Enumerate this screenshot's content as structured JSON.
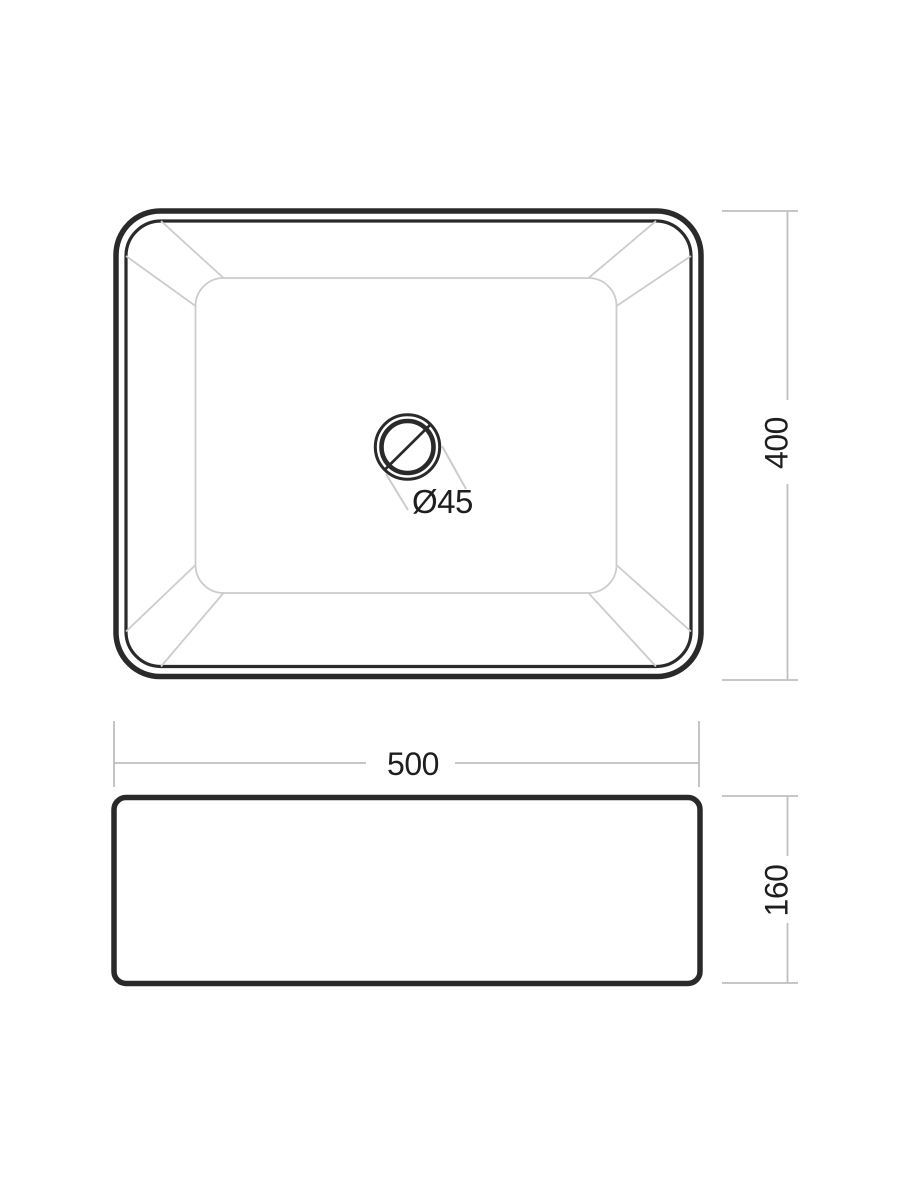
{
  "drawing": {
    "kind": "technical-dimension-drawing",
    "subject": "rectangular-countertop-washbasin",
    "views": [
      "top-view",
      "side-view"
    ]
  },
  "dimensions": {
    "width": {
      "label": "500"
    },
    "depth": {
      "label": "400"
    },
    "height": {
      "label": "160"
    },
    "drain_diameter": {
      "label": "Ø45"
    }
  },
  "colors": {
    "background": "#ffffff",
    "outline_dark": "#2a2a2a",
    "interior_gray": "#cccccc",
    "dimension_gray": "#bfbfbf",
    "text": "#1e1e1e"
  }
}
